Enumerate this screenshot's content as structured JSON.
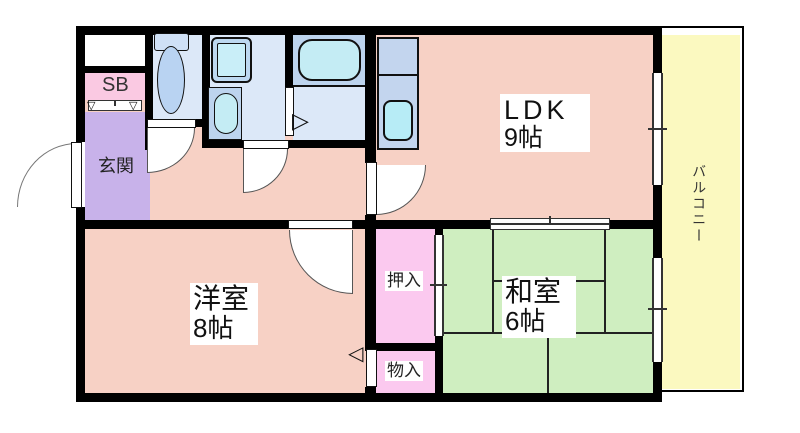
{
  "floorplan": {
    "type": "apartment-floor-plan",
    "labels": {
      "entrance": "玄関",
      "shoe_box": "SB",
      "ldk_name": "LDK",
      "ldk_size": "9帖",
      "western_name": "洋室",
      "western_size": "8帖",
      "japanese_name": "和室",
      "japanese_size": "6帖",
      "closet": "押入",
      "storage": "物入",
      "balcony": "バルコニー"
    },
    "symbols": {
      "shoe_box_triangle_left": "▽",
      "shoe_box_triangle_right": "▽",
      "bath_door_triangle": "▷",
      "storage_door_triangle": "◁"
    },
    "colors": {
      "wall": "#000000",
      "floor_pink": "#f7d1c5",
      "entrance_purple": "#c8b2ea",
      "shoe_box_pink": "#fac9e2",
      "closet_pink": "#fbc9ef",
      "tatami_green": "#cfeec0",
      "balcony_yellow": "#fbf9c0",
      "wet_area_floor_blue": "#dce8f8",
      "fixture_panel_blue": "#bdd4ee",
      "fixture_cyan": "#c2ebf4"
    }
  }
}
